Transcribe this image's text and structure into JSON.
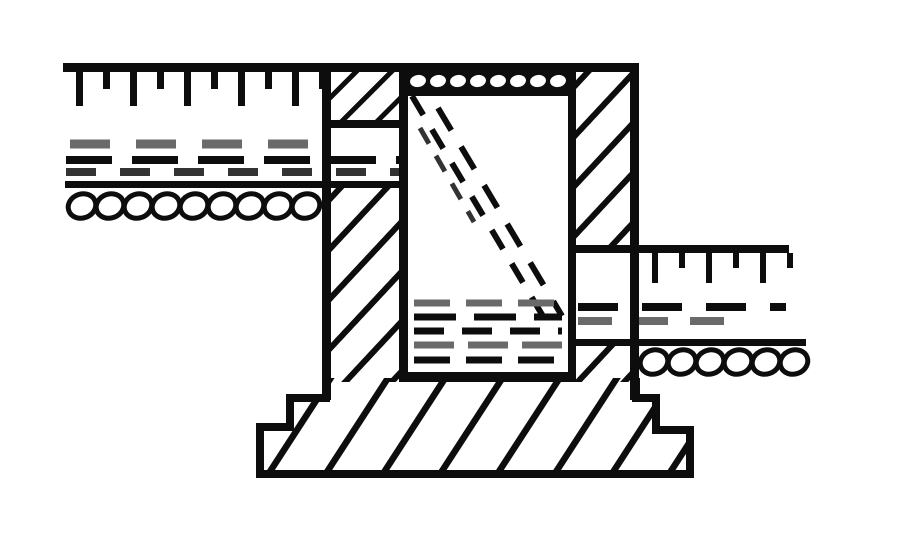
{
  "drawing": {
    "kind": "technical-section-drawing",
    "description_parts": [
      "ground-surface-upper-left",
      "ground-surface-lower-right",
      "soil-dashed-layer",
      "soil-gravel-layer",
      "left-well-wall",
      "right-basement-wall",
      "window-well-shaft",
      "well-grate",
      "window-glazing",
      "stepped-foundation-footing"
    ]
  },
  "colors": {
    "paper": "#ffffff",
    "ink": "#0d0d0d",
    "gray": "#6a6a6a",
    "dark": "#333333"
  },
  "repeats": {
    "ticks_left": {
      "x0": 76,
      "step": 27,
      "count": 10,
      "y": 72,
      "w": 7,
      "longH": 34,
      "shortH": 17
    },
    "ticks_right": {
      "x0": 652,
      "step": 27,
      "count": 6,
      "y": 253,
      "w": 6,
      "longH": 30,
      "shortH": 15
    },
    "gravel_left": {
      "x0": 82,
      "step": 28,
      "count": 9,
      "cy": 206,
      "rx": 14,
      "ry": 12,
      "tilt": -20
    },
    "gravel_right": {
      "x0": 654,
      "step": 28,
      "count": 6,
      "cy": 362,
      "rx": 14,
      "ry": 12,
      "tilt": -20
    },
    "grate_holes": {
      "x0": 418,
      "step": 20,
      "count": 8,
      "cy": 81,
      "rx": 8,
      "ry": 6,
      "tilt": -10
    }
  }
}
